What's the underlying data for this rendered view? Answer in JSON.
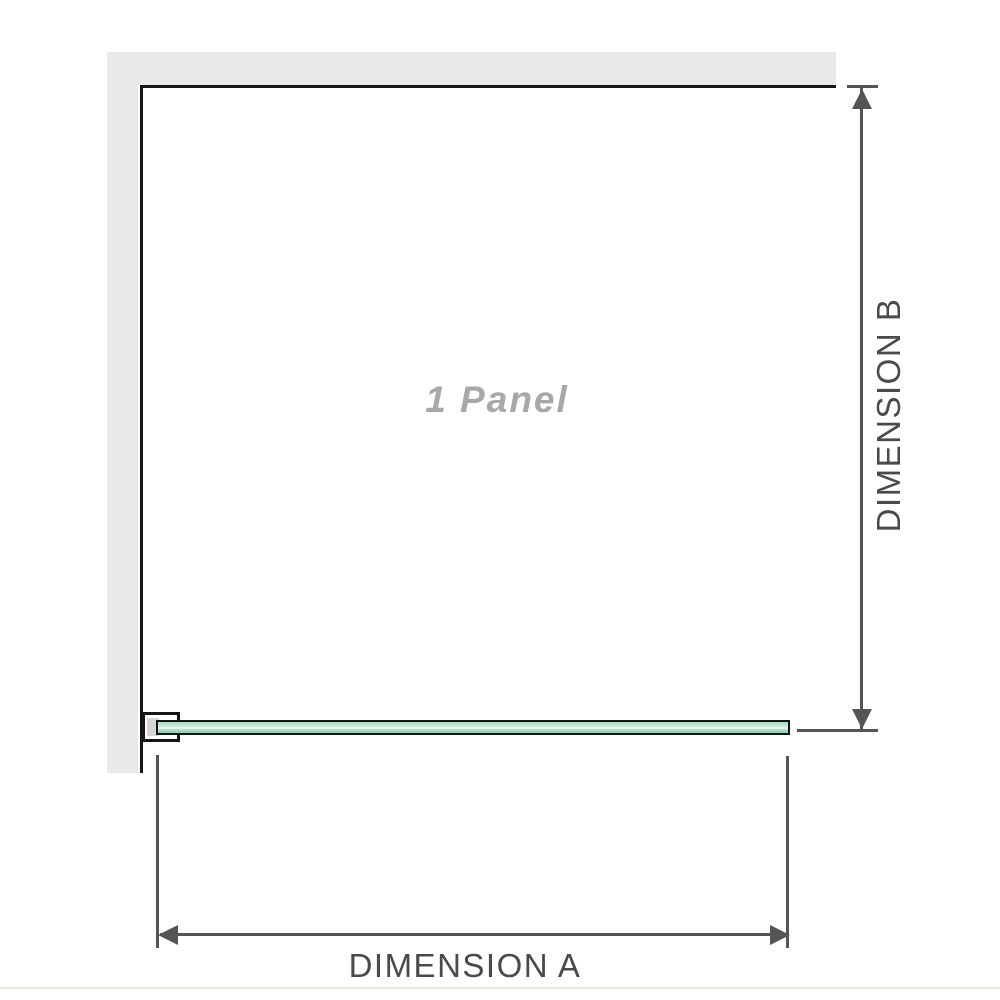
{
  "diagram": {
    "panel_label": "1 Panel",
    "dimension_a_label": "DIMENSION A",
    "dimension_b_label": "DIMENSION B"
  },
  "colors": {
    "wall": "#e9e9e9",
    "outline": "#161616",
    "dimension": "#555555",
    "dimension_text": "#4a4a4a",
    "panel_text": "#a8a8a8",
    "glass_border": "#131313",
    "glass_top": "#a5dabd",
    "glass_mid": "#cdecda",
    "glass_highlight": "#edf9f2",
    "glass_bottom": "#93cdaa",
    "bracket_fill": "#d6d6d6",
    "divider": "#e8e5e0"
  }
}
